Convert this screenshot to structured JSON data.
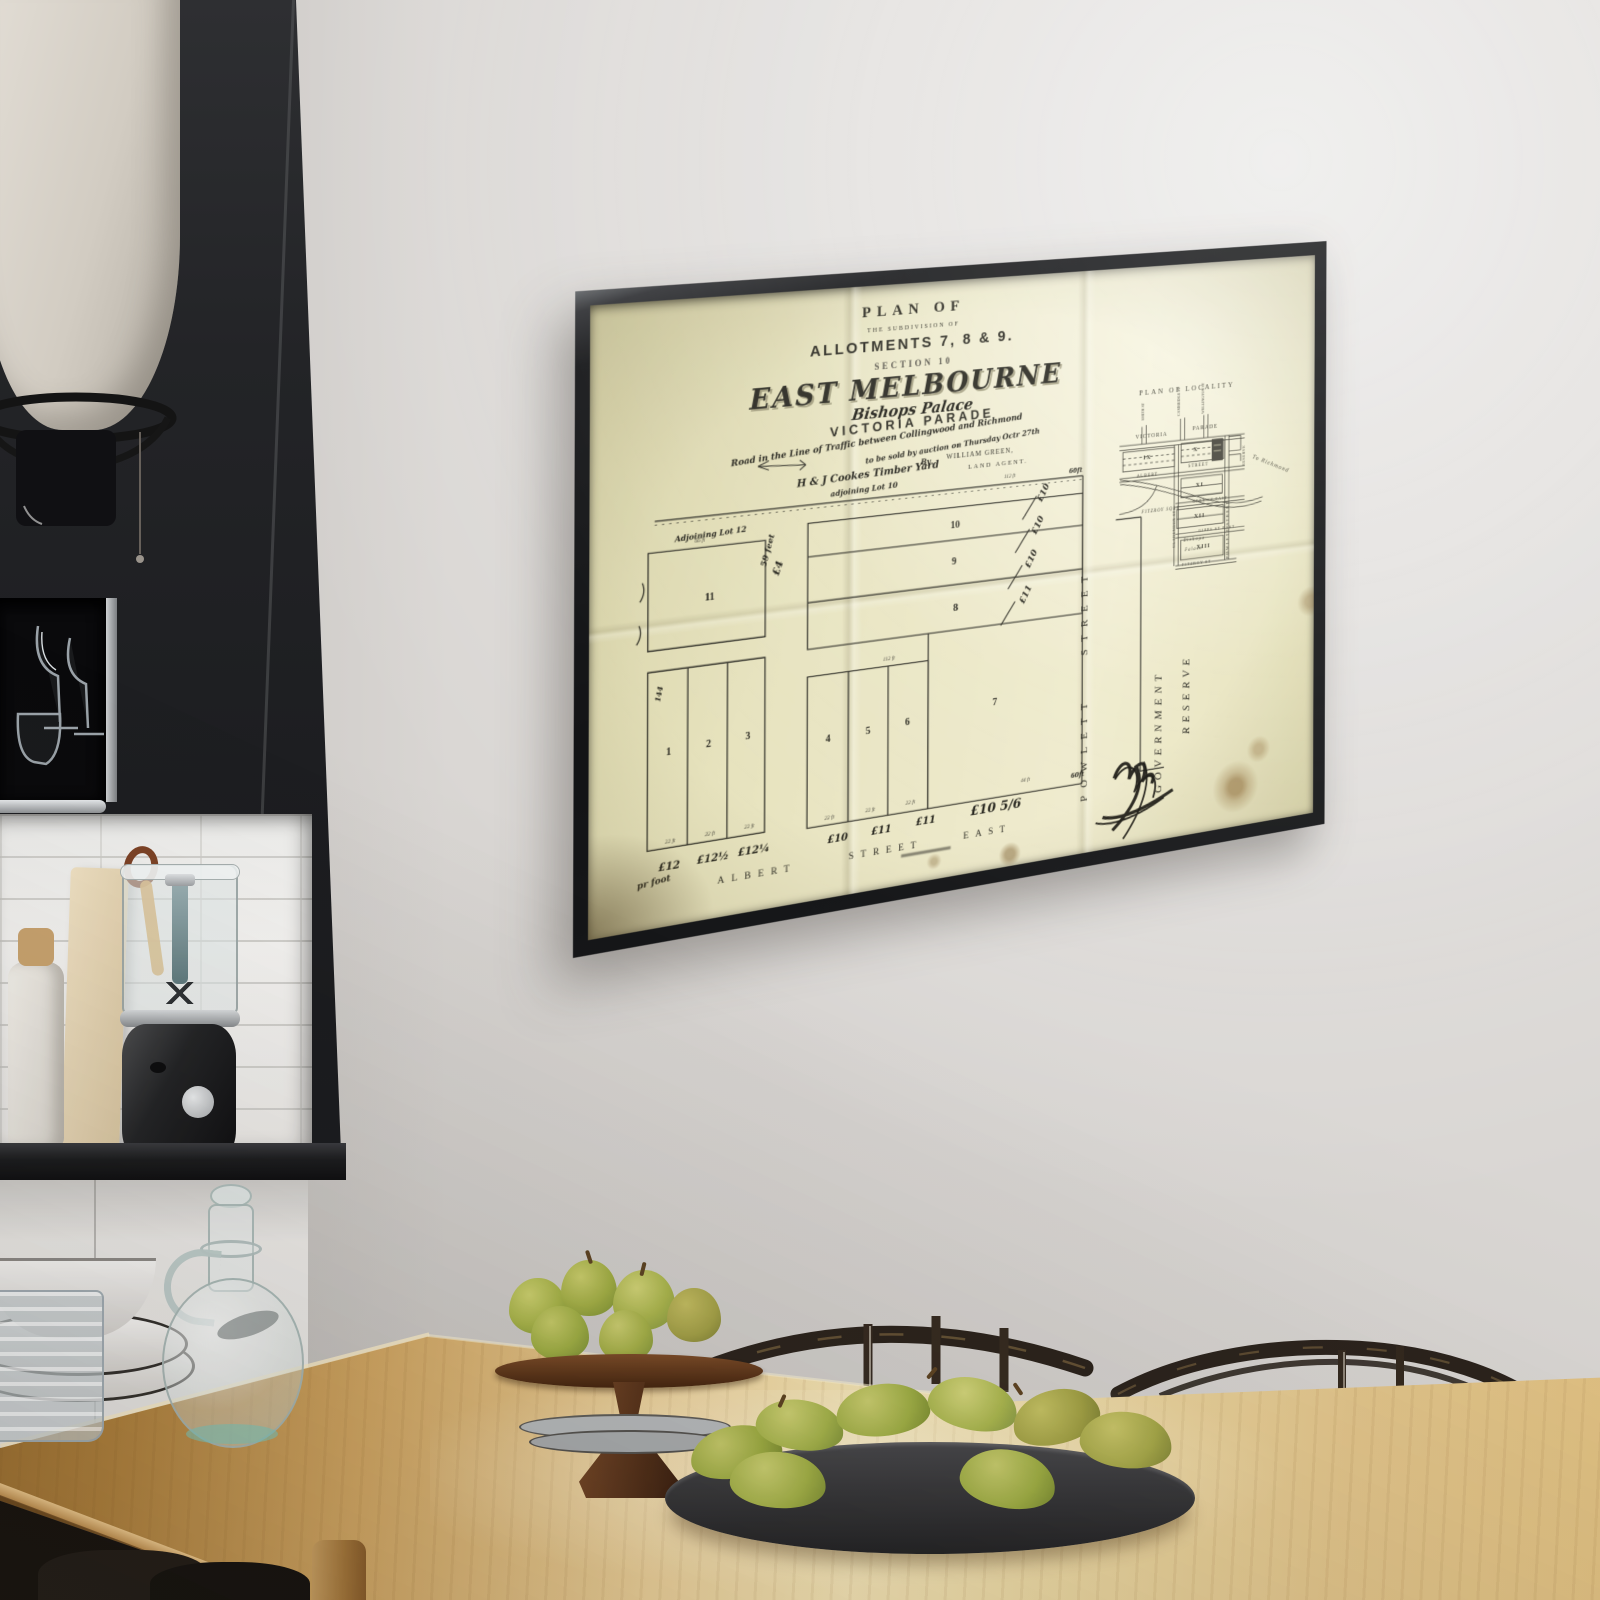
{
  "poster": {
    "heading": {
      "plan_of": "PLAN OF",
      "subdivision": "THE SUBDIVISION OF",
      "allotments": "ALLOTMENTS 7, 8 & 9.",
      "section": "SECTION 10",
      "city": "EAST MELBOURNE",
      "palace": "Bishops Palace",
      "parade": "VICTORIA PARADE",
      "traffic_line": "Road in the Line of Traffic between Collingwood and Richmond",
      "auction_line": "to be sold by auction on Thursday Octr 27th",
      "by_word": "By",
      "agent": "WILLIAM GREEN,",
      "agent_role": "LAND AGENT."
    },
    "plan": {
      "timber_yard": "H & J Cookes Timber Yard",
      "adjoining_lot10": "adjoining Lot 10",
      "adjoining_lot12": "Adjoining Lot 12",
      "lots": [
        "1",
        "2",
        "3",
        "4",
        "5",
        "6",
        "7",
        "8",
        "9",
        "10",
        "11"
      ],
      "dims": [
        "112 ft",
        "112 ft",
        "66 ft",
        "22 ft",
        "22 ft",
        "22 ft",
        "22 ft",
        "22 ft",
        "22 ft",
        "44 ft"
      ],
      "hand_59": "59 feet",
      "hand_4": "£4",
      "hand_144": "144",
      "hand_60_top": "60ft",
      "hand_60_bottom": "60ft",
      "per_foot": "pr foot",
      "prices_bottom": [
        "£12",
        "£12½",
        "£12¼",
        "£10",
        "£11",
        "£11",
        "£10 5/6"
      ],
      "prices_side": [
        "£10",
        "£10",
        "£10",
        "£11"
      ],
      "street_albert": "ALBERT",
      "street_street": "STREET",
      "street_east": "EAST",
      "street_powlett": "POWLETT STREET",
      "reserve_1": "GOVERNMENT",
      "reserve_2": "RESERVE"
    },
    "locality": {
      "title": "PLAN OF LOCALITY",
      "victoria": "VICTORIA",
      "parade": "PARADE",
      "smith": "SMITH ST",
      "cambridge": "CAMBRIDGE ST",
      "wellington": "WELLINGTON ST",
      "albert": "ALBERT",
      "street": "STREET",
      "grey": "GREY ST EAST",
      "gipps": "GIPPS ST EAST",
      "fitzroy_st": "FITZROY ST",
      "fitzroy_sq": "FITZROY SQRE",
      "clarendon": "CLARENDON ST",
      "powlett": "POWLETT STREET",
      "reserve": "RESERVE",
      "richmond": "To Richmond",
      "blocks": [
        "IX",
        "X",
        "XI",
        "XII",
        "XIII"
      ],
      "palace_1": "Bishops",
      "palace_2": "Palace"
    }
  },
  "palette": {
    "frame": "#1a1b1d",
    "paper": "#e9e5c1",
    "ink": "#2a2921",
    "wall": "#d9d6d3",
    "table_wood": "#c89a55",
    "pear_green": "#a9b54a",
    "walnut_stand": "#5b3a21"
  }
}
